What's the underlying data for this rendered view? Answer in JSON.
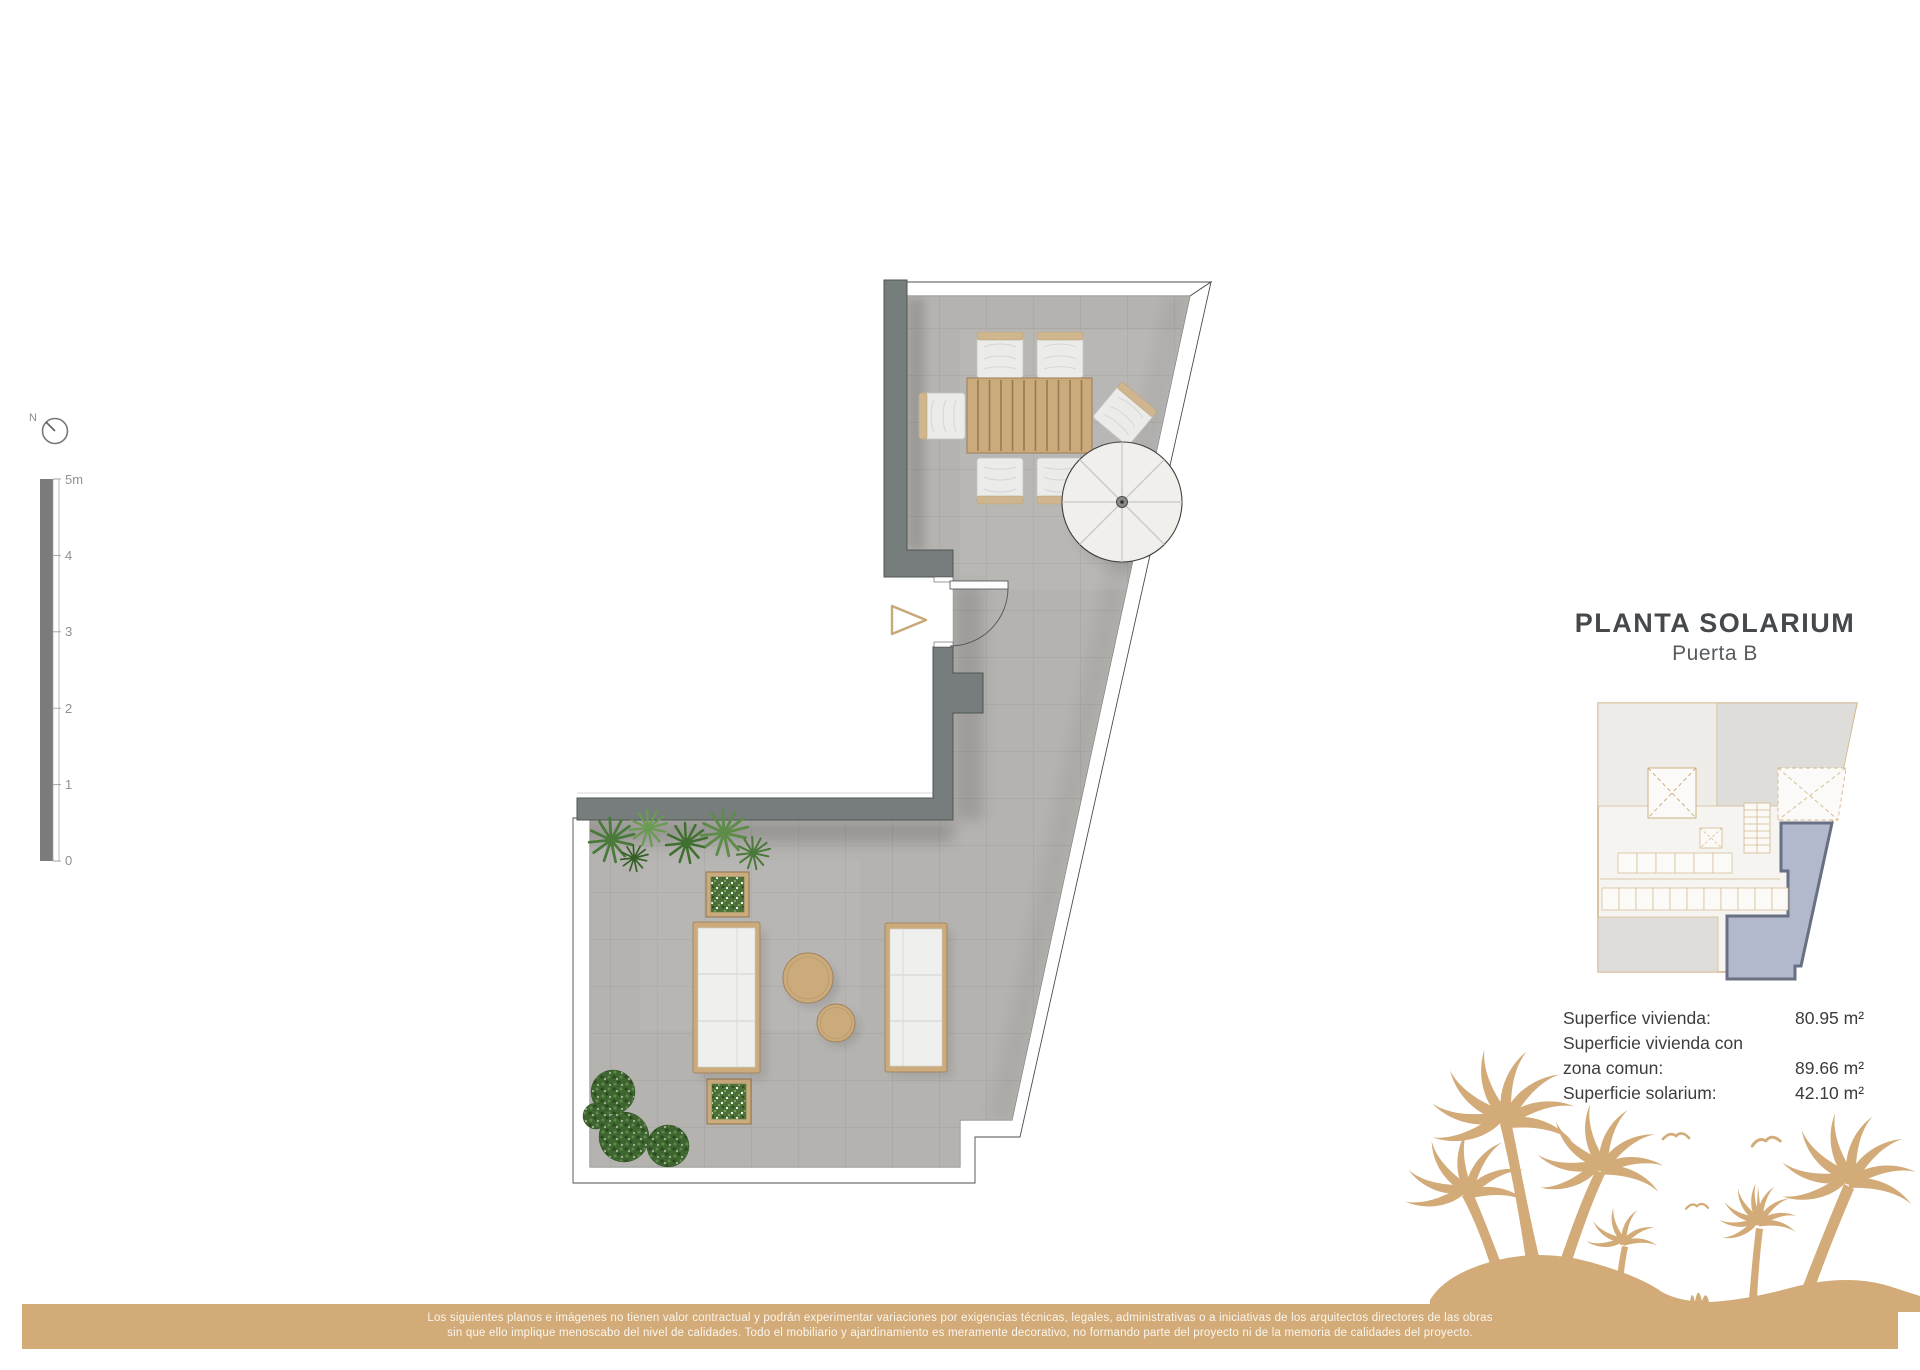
{
  "document": {
    "title": "PLANTA SOLARIUM",
    "subtitle": "Puerta B"
  },
  "compass": {
    "north_label": "N"
  },
  "scale_bar": {
    "unit_labels": [
      "5m",
      "4",
      "3",
      "2",
      "1",
      "0"
    ]
  },
  "areas": {
    "rows": [
      {
        "label": "Superfice vivienda:",
        "value": "80.95 m²"
      },
      {
        "label": "Superficie vivienda con",
        "value": ""
      },
      {
        "label": "zona comun:",
        "value": "89.66 m²"
      },
      {
        "label": "Superficie solarium:",
        "value": "42.10 m²"
      }
    ]
  },
  "footer": {
    "line1": "Los siguientes planos e imágenes no tienen valor contractual y podrán experimentar variaciones por exigencias técnicas, legales, administrativas o a iniciativas de los arquitectos directores de las obras",
    "line2": "sin que ello implique menoscabo del nivel de calidades. Todo el mobiliario y ajardinamiento es meramente decorativo, no formando parte del proyecto ni de la memoria de calidades del proyecto."
  },
  "colors": {
    "accent_tan": "#d2ab79",
    "wood_tan": "#cbaa7c",
    "wall_gray": "#767d7c",
    "floor_gray": "#b5b3b0",
    "highlight_unit_fill": "#b2b9cc",
    "highlight_unit_stroke": "#697083",
    "text_dark": "#45494c"
  }
}
